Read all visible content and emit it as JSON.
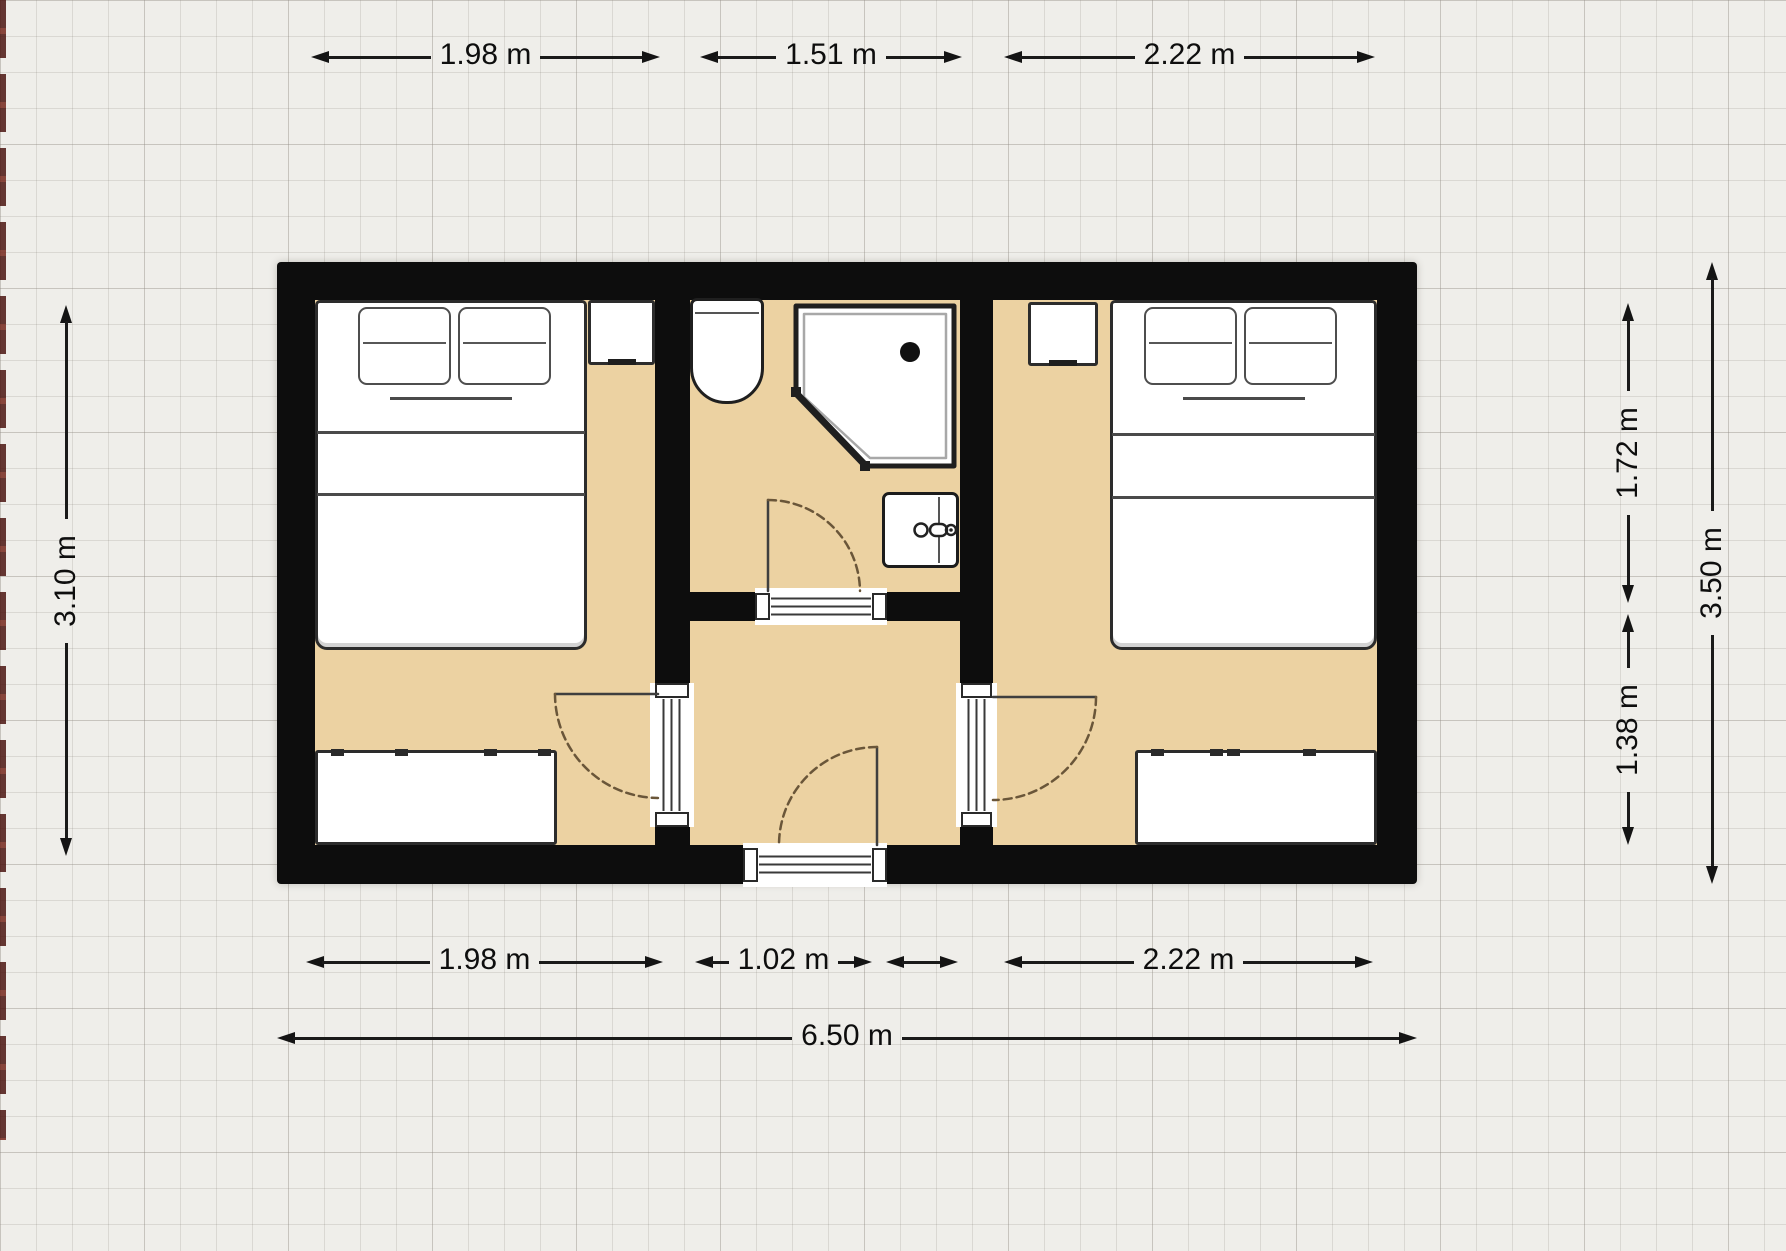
{
  "floorplan": {
    "dimensions": {
      "top": [
        {
          "label": "1.98 m"
        },
        {
          "label": "1.51 m"
        },
        {
          "label": "2.22 m"
        }
      ],
      "bottom": [
        {
          "label": "1.98 m"
        },
        {
          "label": "1.02 m"
        },
        {
          "label": "2.22 m"
        }
      ],
      "bottom_total": {
        "label": "6.50 m"
      },
      "left": {
        "label": "3.10 m"
      },
      "right": [
        {
          "label": "1.72 m"
        },
        {
          "label": "1.38 m"
        }
      ],
      "right_total": {
        "label": "3.50 m"
      }
    },
    "colors": {
      "wall": "#0d0d0d",
      "floor": "#ecd2a2",
      "background": "#efeeea",
      "grid_line": "#cfccc6",
      "furniture_fill": "#ffffff",
      "furniture_outline": "#2c2c2c",
      "door_arc": "#6a5639",
      "dimension_text": "#0e0e0e"
    },
    "rooms": [
      "bedroom-left",
      "bathroom",
      "hallway",
      "bedroom-right"
    ],
    "fixture_icons": [
      "double-bed-icon",
      "pillow-icon",
      "nightstand-icon",
      "wardrobe-icon",
      "toilet-icon",
      "corner-shower-icon",
      "washbasin-icon",
      "faucet-icon",
      "door-swing-icon"
    ]
  }
}
